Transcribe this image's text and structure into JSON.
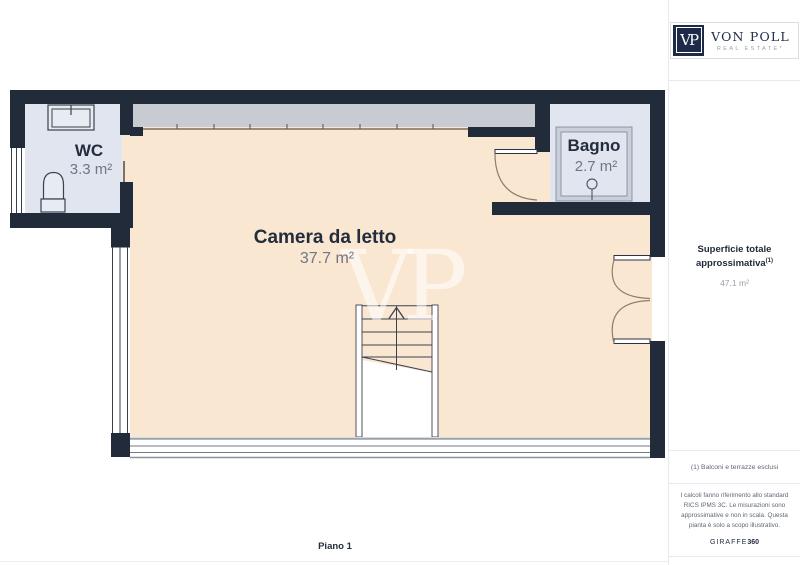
{
  "header": {
    "floor_label": "Piano 1"
  },
  "plan": {
    "watermark": "VP",
    "rooms": {
      "wc": {
        "name": "WC",
        "area": "3.3 m²"
      },
      "bedroom": {
        "name": "Camera da letto",
        "area": "37.7 m²"
      },
      "bathroom": {
        "name": "Bagno",
        "area": "2.7 m²"
      }
    },
    "colors": {
      "wall": "#212b3a",
      "bedroom_floor": "#fae7d2",
      "wet_room_floor": "#e0e5ef",
      "glazing_band": "#c9cbd2",
      "fixture_fill": "#e7ebf2"
    }
  },
  "sidebar": {
    "logo": {
      "monogram": "VP",
      "brand_name": "VON POLL",
      "brand_tagline": "REAL ESTATE*"
    },
    "total_area": {
      "label_line1": "Superficie totale",
      "label_line2": "approssimativa",
      "footnote_marker": "(1)",
      "value": "47.1 m²"
    },
    "footnote": "(1) Balconi e terrazze esclusi",
    "disclaimer": "I calcoli fanno riferimento allo standard RICS IPMS 3C. Le misurazioni sono approssimative e non in scala. Questa pianta è solo a scopo illustrativo.",
    "credit": {
      "prefix": "GIRAFFE",
      "suffix": "360"
    }
  }
}
